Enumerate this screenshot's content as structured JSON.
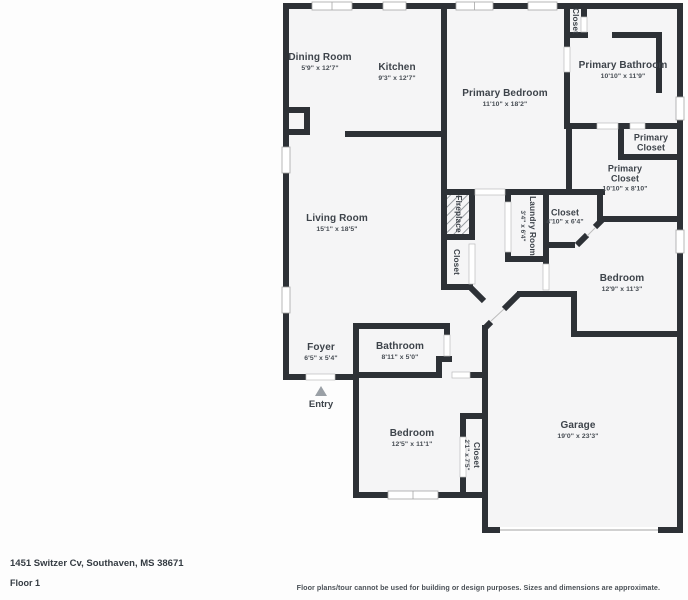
{
  "palette": {
    "page_background": "#fdfdfd",
    "floor_color": "#f5f5f6",
    "wall_color": "#2d3136",
    "label_color": "#3d434a",
    "entry_arrow_color": "#9aa0a6"
  },
  "rooms": [
    {
      "name": "Dining Room",
      "dims": "5'9\" x 12'7\""
    },
    {
      "name": "Kitchen",
      "dims": "9'3\" x 12'7\""
    },
    {
      "name": "Primary Bedroom",
      "dims": "11'10\" x 18'2\""
    },
    {
      "name": "Closet",
      "dims": ""
    },
    {
      "name": "Primary Bathroom",
      "dims": "10'10\" x 11'9\""
    },
    {
      "name": "Primary Closet",
      "dims": ""
    },
    {
      "name": "Primary Closet",
      "dims": "10'10\" x 8'10\""
    },
    {
      "name": "Closet",
      "dims": "4'10\" x 6'4\""
    },
    {
      "name": "Laundry Room",
      "dims": "3'4\" x 6'4\""
    },
    {
      "name": "Fireplace",
      "dims": ""
    },
    {
      "name": "Closet",
      "dims": ""
    },
    {
      "name": "Living Room",
      "dims": "15'1\" x 18'5\""
    },
    {
      "name": "Bedroom",
      "dims": "12'9\" x 11'3\""
    },
    {
      "name": "Foyer",
      "dims": "6'5\" x 5'4\""
    },
    {
      "name": "Bathroom",
      "dims": "8'11\" x 5'0\""
    },
    {
      "name": "Bedroom",
      "dims": "12'5\" x 11'1\""
    },
    {
      "name": "Closet",
      "dims": "2'1\" x 7'5\""
    },
    {
      "name": "Garage",
      "dims": "19'0\" x 23'3\""
    }
  ],
  "entry": {
    "label": "Entry"
  },
  "footer": {
    "address": "1451 Switzer Cv, Southaven, MS 38671",
    "floor_label": "Floor 1",
    "disclaimer": "Floor plans/tour cannot be used for building or design purposes. Sizes and dimensions are approximate."
  }
}
